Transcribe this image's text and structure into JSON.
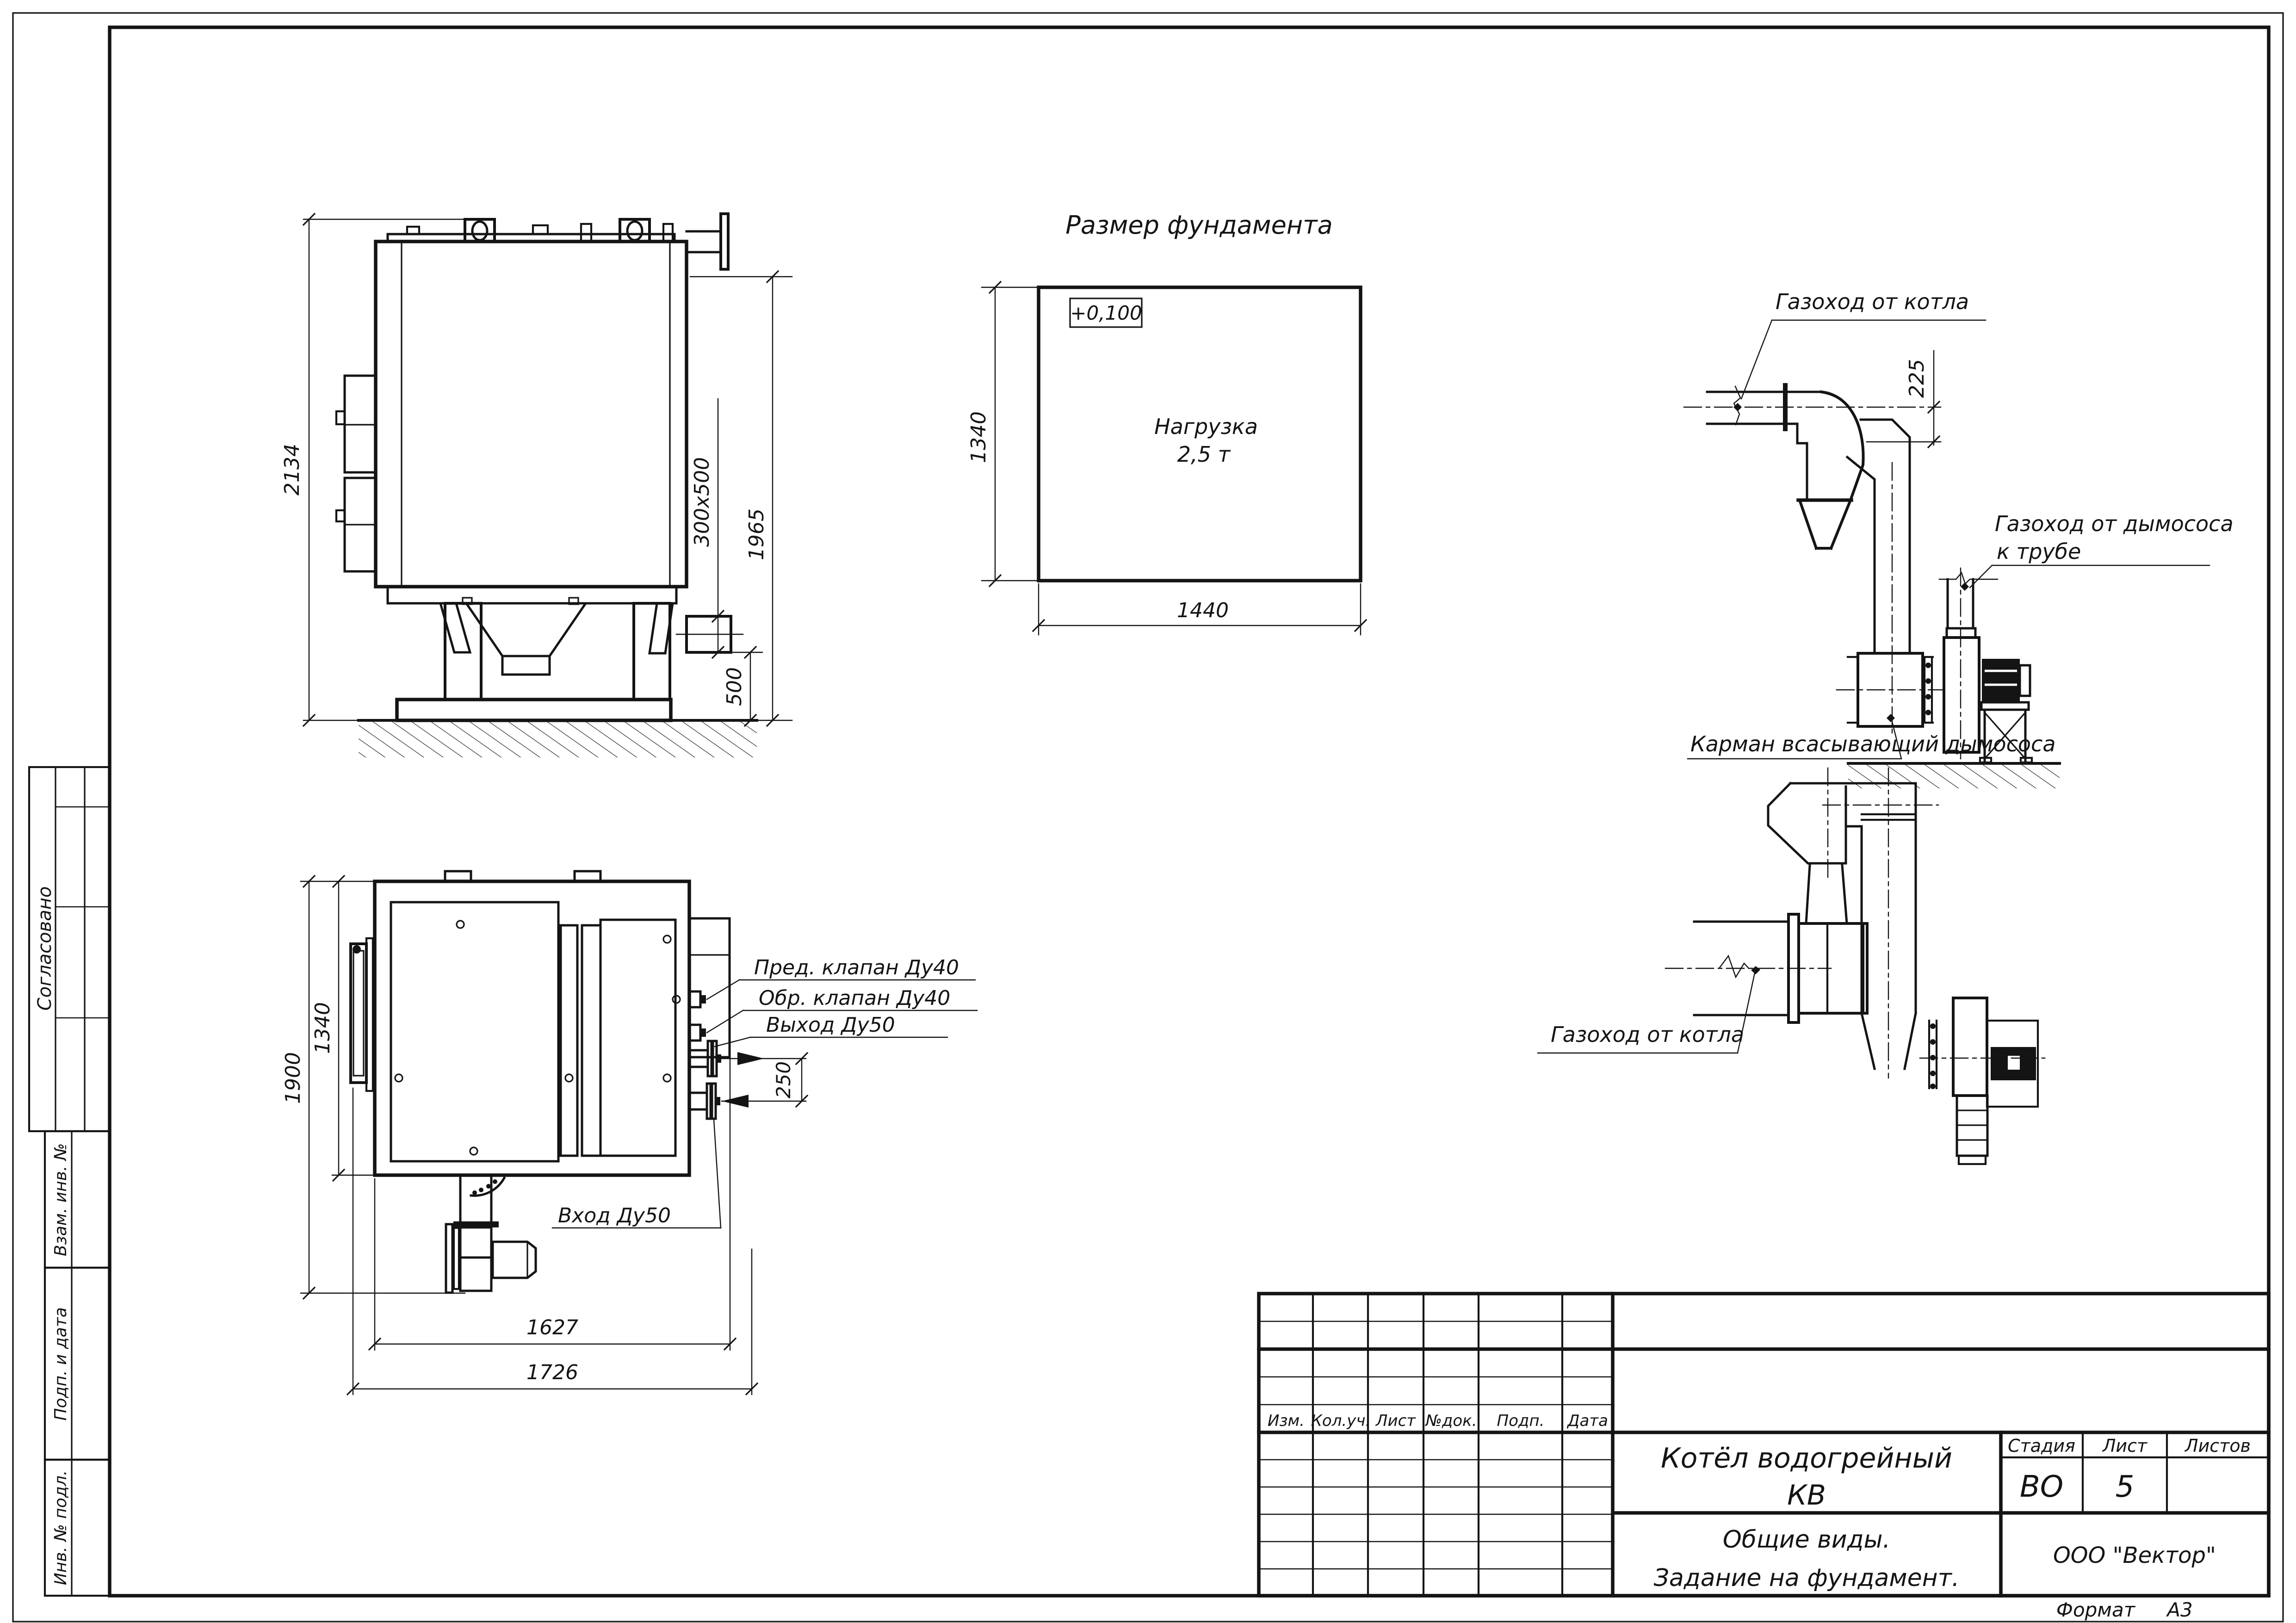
{
  "colors": {
    "ink": "#141414",
    "paper": "#ffffff"
  },
  "sheet": {
    "format_label": "Формат",
    "format_value": "А3"
  },
  "side_stamps": {
    "agreed": "Согласовано",
    "replace_inv": "Взам. инв. №",
    "sign_date": "Подп. и дата",
    "inv_original": "Инв. № подл."
  },
  "title_block": {
    "product_line1": "Котёл водогрейный",
    "product_line2": "КВ",
    "doc_line1": "Общие виды.",
    "doc_line2": "Задание на фундамент.",
    "company": "ООО \"Вектор\"",
    "stage_label": "Стадия",
    "sheet_label": "Лист",
    "sheets_label": "Листов",
    "stage_value": "ВО",
    "sheet_value": "5",
    "columns": [
      "Изм.",
      "Кол.уч.",
      "Лист",
      "№док.",
      "Подп.",
      "Дата"
    ]
  },
  "front_view": {
    "dim_overall_height": "2134",
    "dim_opening": "300х500",
    "dim_flange_height": "1965",
    "dim_base": "500"
  },
  "foundation": {
    "title": "Размер фундамента",
    "elevation_mark": "+0,100",
    "load_line1": "Нагрузка",
    "load_line2": "2,5 т",
    "dim_depth": "1340",
    "dim_width": "1440"
  },
  "plan_view": {
    "dim_overall": "1900",
    "dim_body": "1340",
    "dim_nozzles": "250",
    "dim_length_inner": "1627",
    "dim_length_overall": "1726",
    "label_safety_valve": "Пред. клапан Ду40",
    "label_check_valve": "Обр. клапан Ду40",
    "label_outlet": "Выход Ду50",
    "label_inlet": "Вход Ду50"
  },
  "duct_elevation": {
    "label_from_boiler": "Газоход от котла",
    "label_to_stack_line1": "Газоход от дымососа",
    "label_to_stack_line2": "к трубе",
    "label_pocket": "Карман всасывающий дымососа",
    "dim_offset": "225"
  },
  "duct_plan": {
    "label_from_boiler": "Газоход от котла"
  }
}
